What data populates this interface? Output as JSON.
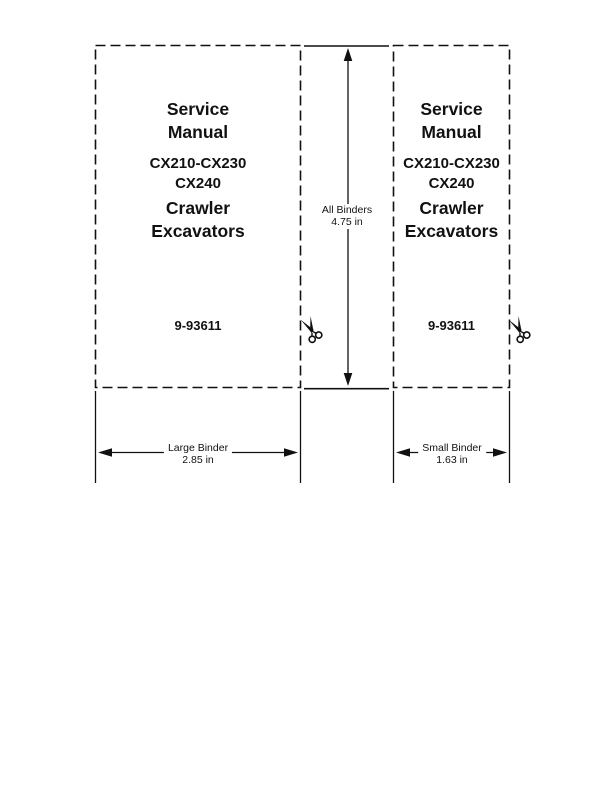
{
  "page": {
    "background": "#ffffff",
    "ink": "#111111"
  },
  "large_binder_label": {
    "title_line1": "Service",
    "title_line2": "Manual",
    "model_line1": "CX210-CX230",
    "model_line2": "CX240",
    "product_line1": "Crawler",
    "product_line2": "Excavators",
    "part_number": "9-93611"
  },
  "small_binder_label": {
    "title_line1": "Service",
    "title_line2": "Manual",
    "model_line1": "CX210-CX230",
    "model_line2": "CX240",
    "product_line1": "Crawler",
    "product_line2": "Excavators",
    "part_number": "9-93611"
  },
  "dimensions": {
    "all_binders_line1": "All Binders",
    "all_binders_line2": "4.75 in",
    "large_binder_line1": "Large Binder",
    "large_binder_line2": "2.85 in",
    "small_binder_line1": "Small Binder",
    "small_binder_line2": "1.63 in"
  },
  "icons": {
    "scissors_icon": "✂"
  }
}
